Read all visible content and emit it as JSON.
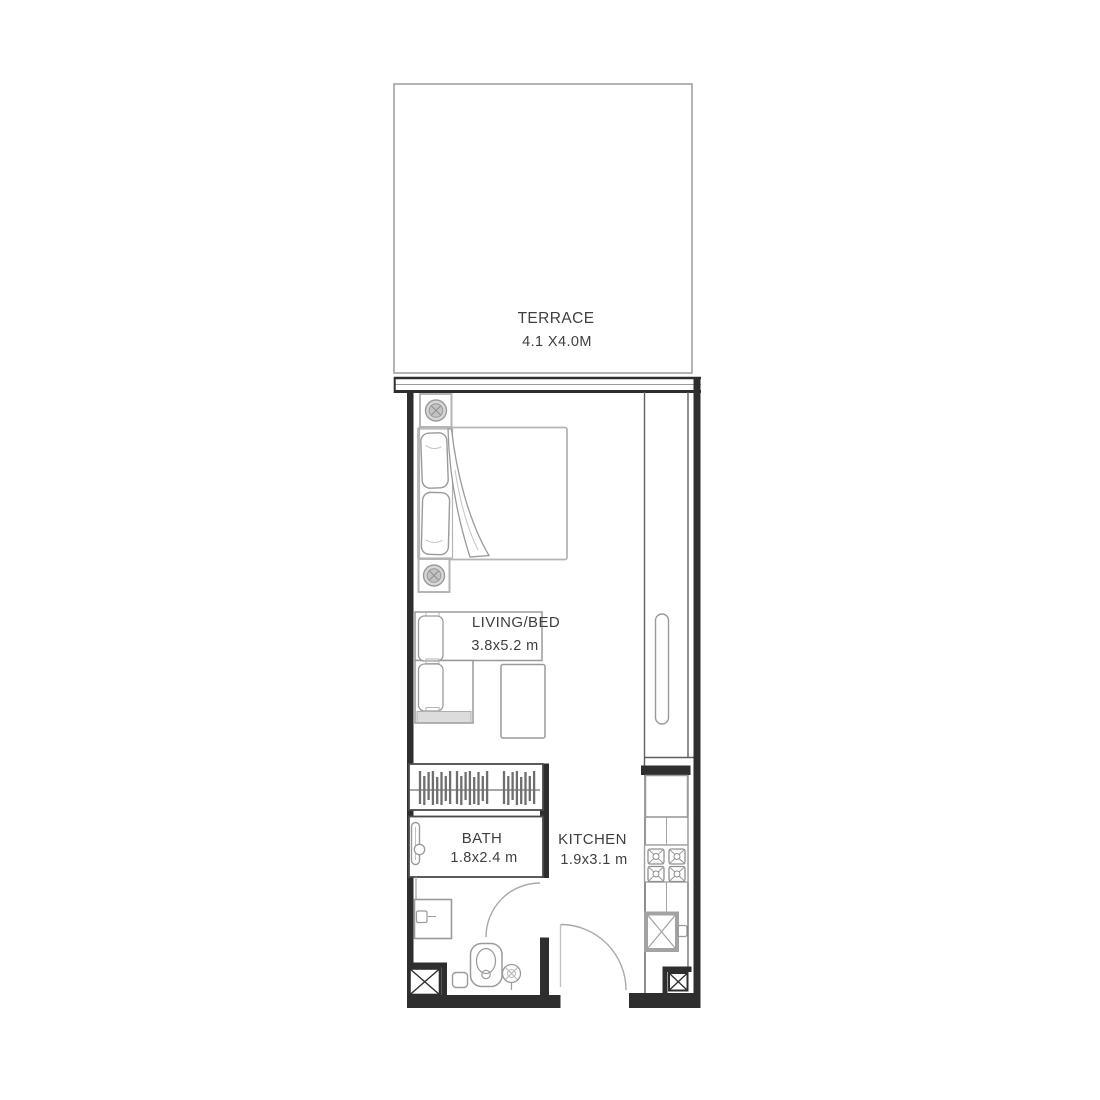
{
  "rooms": {
    "terrace": {
      "name": "TERRACE",
      "dimensions": "4.1 X4.0M"
    },
    "living_bed": {
      "name": "LIVING/BED",
      "dimensions": "3.8x5.2 m"
    },
    "bath": {
      "name": "BATH",
      "dimensions": "1.8x2.4 m"
    },
    "kitchen": {
      "name": "KITCHEN",
      "dimensions": "1.9x3.1 m"
    }
  },
  "colors": {
    "background": "#ffffff",
    "wall": "#2e2e2e",
    "partition_line": "#5f5f5f",
    "furniture_line": "#9a9a9a",
    "light_line": "#b5b5b5",
    "door_arc": "#a8a8a8",
    "text": "#3f3f3f"
  },
  "symbols": {
    "bedroom": [
      "double-bed",
      "pillows",
      "blanket-fold",
      "nightstand-lamp-top",
      "nightstand-lamp-bottom"
    ],
    "living": [
      "l-shaped-sofa",
      "coffee-table",
      "wardrobe-with-hangers",
      "tall-panel"
    ],
    "bath": [
      "shower-mixer",
      "washbasin",
      "toilet",
      "floor-drain",
      "round-drain",
      "door-swing"
    ],
    "kitchen": [
      "fridge",
      "base-cabinets",
      "hob-four-burners",
      "sink",
      "entry-door-swing"
    ],
    "shafts": [
      "shaft-cross-left",
      "shaft-cross-right"
    ]
  }
}
